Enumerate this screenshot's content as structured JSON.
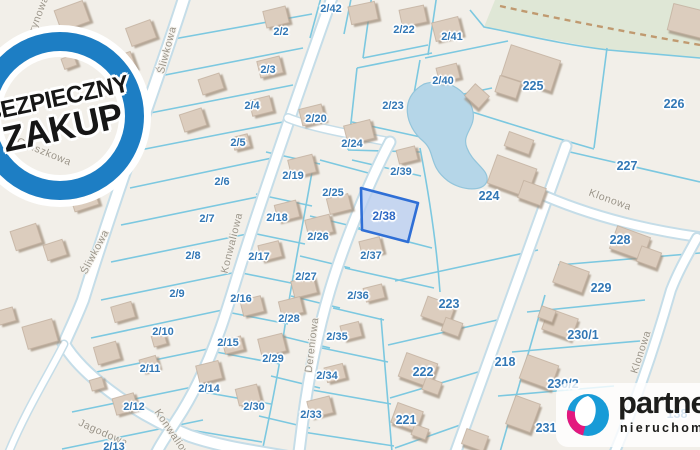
{
  "badge": {
    "text_line1": "BEZPIECZNY",
    "text_line2": "ZAKUP"
  },
  "logo": {
    "brand": "partner",
    "subtitle": "nieruchomości"
  },
  "map": {
    "highlighted_parcel": "2/38",
    "colors": {
      "highlight_fill": "#b7cdf2",
      "highlight_border": "#2f6fd6",
      "parcel_line": "#7cc8e0",
      "label_blue": "#3277b5",
      "water": "#b5d6e8",
      "building": "#dccdbe",
      "road": "#ffffff",
      "green_area": "#dfe7d6",
      "badge_blue": "#1d7ec4",
      "logo_blue": "#189bd7",
      "logo_magenta": "#e3187e"
    },
    "parcel_labels": [
      {
        "id": "2/42",
        "x": 331,
        "y": 9,
        "size": "s"
      },
      {
        "id": "2/22",
        "x": 404,
        "y": 30,
        "size": "s"
      },
      {
        "id": "2/41",
        "x": 452,
        "y": 37,
        "size": "s"
      },
      {
        "id": "2/2",
        "x": 281,
        "y": 32,
        "size": "s"
      },
      {
        "id": "2/3",
        "x": 268,
        "y": 70,
        "size": "s"
      },
      {
        "id": "2/40",
        "x": 443,
        "y": 81,
        "size": "s"
      },
      {
        "id": "2/23",
        "x": 393,
        "y": 106,
        "size": "s"
      },
      {
        "id": "2/4",
        "x": 252,
        "y": 106,
        "size": "s"
      },
      {
        "id": "2/20",
        "x": 316,
        "y": 119,
        "size": "s"
      },
      {
        "id": "2/5",
        "x": 238,
        "y": 143,
        "size": "s"
      },
      {
        "id": "2/24",
        "x": 352,
        "y": 144,
        "size": "s"
      },
      {
        "id": "2/39",
        "x": 401,
        "y": 172,
        "size": "s"
      },
      {
        "id": "2/19",
        "x": 293,
        "y": 176,
        "size": "s"
      },
      {
        "id": "2/6",
        "x": 222,
        "y": 182,
        "size": "s"
      },
      {
        "id": "2/25",
        "x": 333,
        "y": 193,
        "size": "s"
      },
      {
        "id": "2/38",
        "x": 384,
        "y": 216,
        "size": "h"
      },
      {
        "id": "2/18",
        "x": 277,
        "y": 218,
        "size": "s"
      },
      {
        "id": "2/7",
        "x": 207,
        "y": 219,
        "size": "s"
      },
      {
        "id": "2/26",
        "x": 318,
        "y": 237,
        "size": "s"
      },
      {
        "id": "2/17",
        "x": 259,
        "y": 257,
        "size": "s"
      },
      {
        "id": "2/37",
        "x": 371,
        "y": 256,
        "size": "s"
      },
      {
        "id": "2/8",
        "x": 193,
        "y": 256,
        "size": "s"
      },
      {
        "id": "2/27",
        "x": 306,
        "y": 277,
        "size": "s"
      },
      {
        "id": "2/9",
        "x": 177,
        "y": 294,
        "size": "s"
      },
      {
        "id": "2/16",
        "x": 241,
        "y": 299,
        "size": "s"
      },
      {
        "id": "2/36",
        "x": 358,
        "y": 296,
        "size": "s"
      },
      {
        "id": "2/28",
        "x": 289,
        "y": 319,
        "size": "s"
      },
      {
        "id": "2/10",
        "x": 163,
        "y": 332,
        "size": "s"
      },
      {
        "id": "2/15",
        "x": 228,
        "y": 343,
        "size": "s"
      },
      {
        "id": "2/35",
        "x": 337,
        "y": 337,
        "size": "s"
      },
      {
        "id": "2/29",
        "x": 273,
        "y": 359,
        "size": "s"
      },
      {
        "id": "2/11",
        "x": 150,
        "y": 369,
        "size": "s"
      },
      {
        "id": "2/34",
        "x": 327,
        "y": 376,
        "size": "s"
      },
      {
        "id": "2/14",
        "x": 209,
        "y": 389,
        "size": "s"
      },
      {
        "id": "2/30",
        "x": 254,
        "y": 407,
        "size": "s"
      },
      {
        "id": "2/12",
        "x": 134,
        "y": 407,
        "size": "s"
      },
      {
        "id": "2/33",
        "x": 311,
        "y": 415,
        "size": "s"
      },
      {
        "id": "2/13",
        "x": 114,
        "y": 447,
        "size": "s"
      },
      {
        "id": "225",
        "x": 533,
        "y": 86,
        "size": "l"
      },
      {
        "id": "226",
        "x": 674,
        "y": 104,
        "size": "l"
      },
      {
        "id": "227",
        "x": 627,
        "y": 166,
        "size": "l"
      },
      {
        "id": "224",
        "x": 489,
        "y": 196,
        "size": "l"
      },
      {
        "id": "228",
        "x": 620,
        "y": 240,
        "size": "l"
      },
      {
        "id": "229",
        "x": 601,
        "y": 288,
        "size": "l"
      },
      {
        "id": "223",
        "x": 449,
        "y": 304,
        "size": "l"
      },
      {
        "id": "230/1",
        "x": 583,
        "y": 335,
        "size": "l"
      },
      {
        "id": "218",
        "x": 505,
        "y": 362,
        "size": "l"
      },
      {
        "id": "222",
        "x": 423,
        "y": 372,
        "size": "l"
      },
      {
        "id": "230/2",
        "x": 563,
        "y": 384,
        "size": "l"
      },
      {
        "id": "221",
        "x": 406,
        "y": 420,
        "size": "l"
      },
      {
        "id": "231",
        "x": 546,
        "y": 428,
        "size": "l"
      },
      {
        "id": "138",
        "x": 677,
        "y": 414,
        "size": "l"
      }
    ],
    "street_labels": [
      {
        "name": "Cytrynowa",
        "x": 36,
        "y": 22,
        "angle": -69
      },
      {
        "name": "Śliwkowa",
        "x": 167,
        "y": 50,
        "angle": -75
      },
      {
        "name": "Gruszkowa",
        "x": 44,
        "y": 152,
        "angle": 22
      },
      {
        "name": "Śliwkowa",
        "x": 95,
        "y": 252,
        "angle": -62
      },
      {
        "name": "Konwaliowa",
        "x": 232,
        "y": 243,
        "angle": -76
      },
      {
        "name": "Dereniowa",
        "x": 312,
        "y": 345,
        "angle": -83
      },
      {
        "name": "Jagodowa",
        "x": 103,
        "y": 433,
        "angle": 24
      },
      {
        "name": "Konwaliowa",
        "x": 174,
        "y": 436,
        "angle": 56
      },
      {
        "name": "Klonowa",
        "x": 610,
        "y": 200,
        "angle": 20
      },
      {
        "name": "Klonowa",
        "x": 641,
        "y": 352,
        "angle": -72
      }
    ]
  }
}
